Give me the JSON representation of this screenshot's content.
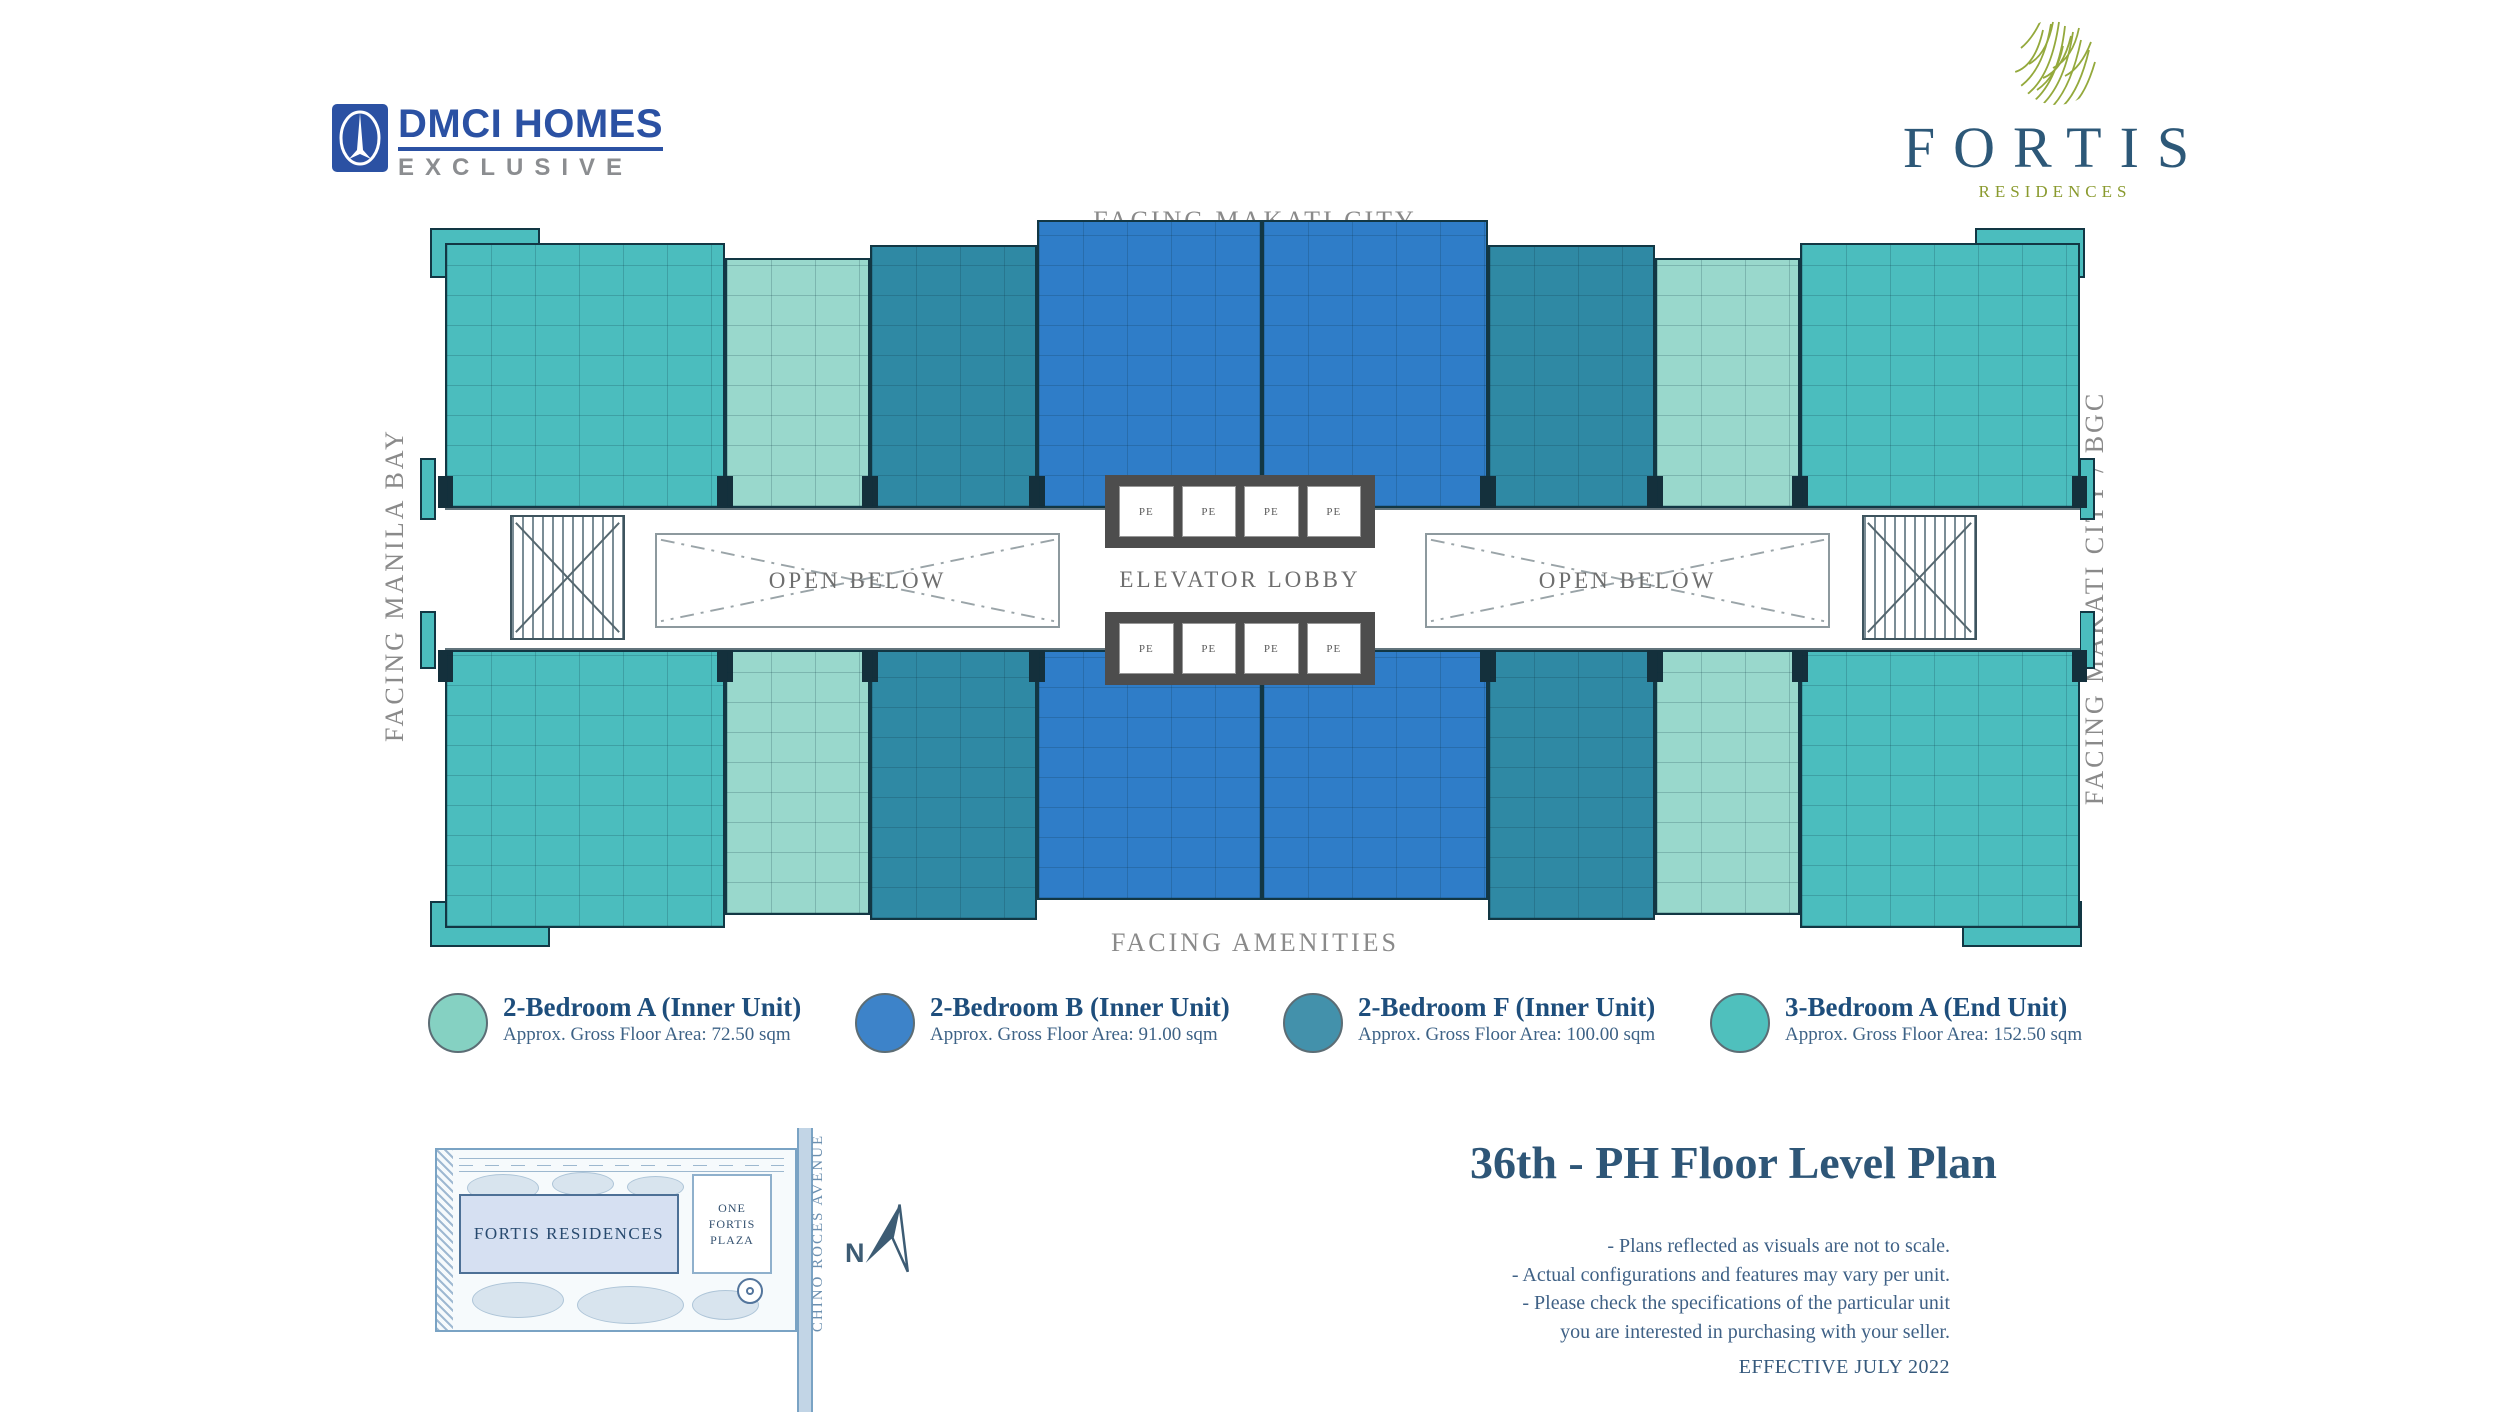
{
  "branding": {
    "dmci_name": "DMCI HOMES",
    "dmci_sub": "EXCLUSIVE",
    "fortis_name": "FORTIS",
    "fortis_sub": "RESIDENCES"
  },
  "floor_plan": {
    "facing_top": "FACING MAKATI CITY",
    "facing_bottom": "FACING AMENITIES",
    "facing_left": "FACING MANILA BAY",
    "facing_right": "FACING MAKATI CITY / BGC",
    "elevator_lobby_label": "ELEVATOR LOBBY",
    "open_below_label": "OPEN BELOW",
    "elevator_cell_label": "PE"
  },
  "legend": {
    "items": [
      {
        "name": "2-Bedroom A (Inner Unit)",
        "area": "Approx. Gross Floor Area: 72.50 sqm",
        "color": "#85d1c2"
      },
      {
        "name": "2-Bedroom B (Inner Unit)",
        "area": "Approx. Gross Floor Area: 91.00 sqm",
        "color": "#3d83c9"
      },
      {
        "name": "2-Bedroom F (Inner Unit)",
        "area": "Approx. Gross Floor Area: 100.00 sqm",
        "color": "#4391ab"
      },
      {
        "name": "3-Bedroom A (End Unit)",
        "area": "Approx. Gross Floor Area: 152.50 sqm",
        "color": "#4fc0bd"
      }
    ]
  },
  "site_map": {
    "building_label": "FORTIS RESIDENCES",
    "neighbor_line1": "ONE",
    "neighbor_line2": "FORTIS",
    "neighbor_line3": "PLAZA",
    "street_label": "CHINO ROCES AVENUE",
    "north_label": "N"
  },
  "title_block": {
    "title": "36th - PH Floor Level Plan",
    "note1": "- Plans reflected as visuals are not to scale.",
    "note2": "- Actual configurations and features may vary per unit.",
    "note3": "- Please check the specifications of the particular unit",
    "note4": "you are interested in purchasing with your seller.",
    "effective": "EFFECTIVE JULY 2022"
  },
  "colors": {
    "unit_2br_a_mint": "#99d8cc",
    "unit_2br_b_blue": "#2f7dc8",
    "unit_2br_f_teal": "#2f89a4",
    "unit_3br_a_turquoise": "#4bbdbe",
    "navy_text": "#2e5677",
    "facing_gray": "#8a8a8a",
    "dmci_blue": "#2b51a3",
    "fortis_olive": "#94a93c"
  }
}
